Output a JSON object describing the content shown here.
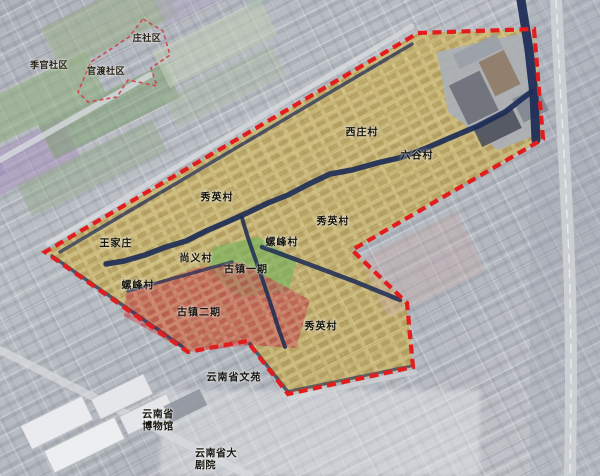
{
  "map": {
    "description_labels": "satellite planning map with red dashed project boundary",
    "colors": {
      "boundary_red": "#e21d1d",
      "secondary_boundary_red": "#cf4a52",
      "zone_yellow": "#e0b93a",
      "ancient_town_phase1_green": "#6eb45c",
      "ancient_town_phase2_pink": "#cd5f64",
      "river_navy": "#1b2a55",
      "road_light": "#d6d9dd"
    }
  },
  "labels": [
    {
      "text": "庄社区"
    },
    {
      "text": "季官社区"
    },
    {
      "text": "官渡社区"
    },
    {
      "text": "西庄村"
    },
    {
      "text": "六谷村"
    },
    {
      "text": "秀英村"
    },
    {
      "text": "秀英村"
    },
    {
      "text": "王家庄"
    },
    {
      "text": "螺峰村"
    },
    {
      "text": "尚义村"
    },
    {
      "text": "古镇一期"
    },
    {
      "text": "螺峰村"
    },
    {
      "text": "古镇二期"
    },
    {
      "text": "秀英村"
    },
    {
      "text": "云南省文苑"
    },
    {
      "text": "云南省\n博物馆"
    },
    {
      "text": "云南省大\n剧院"
    }
  ]
}
